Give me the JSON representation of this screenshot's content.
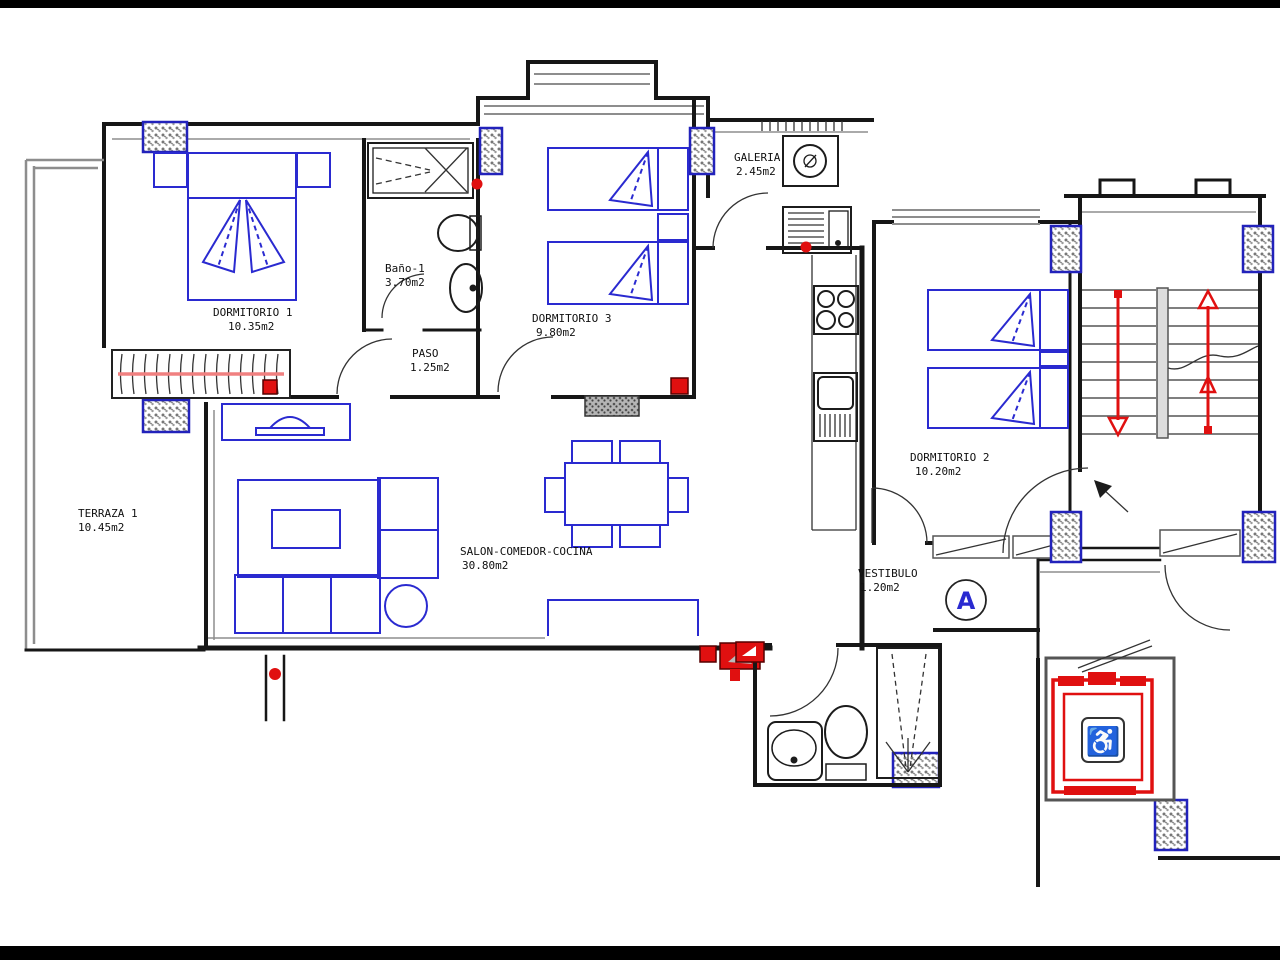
{
  "plan": {
    "rooms": [
      {
        "name": "DORMITORIO 1",
        "area": "10.35m2"
      },
      {
        "name": "Baño-1",
        "area": "3.70m2"
      },
      {
        "name": "DORMITORIO 3",
        "area": "9.80m2"
      },
      {
        "name": "GALERIA",
        "area": "2.45m2"
      },
      {
        "name": "PASO",
        "area": "1.25m2"
      },
      {
        "name": "TERRAZA 1",
        "area": "10.45m2"
      },
      {
        "name": "SALON-COMEDOR-COCINA",
        "area": "30.80m2"
      },
      {
        "name": "DORMITORIO 2",
        "area": "10.20m2"
      },
      {
        "name": "VESTIBULO",
        "area": "1.20m2"
      }
    ],
    "section_label": "A",
    "icons": {
      "wheelchair": "♿"
    },
    "colors": {
      "wall": "#161616",
      "furniture": "#2a2ad0",
      "accent_red": "#e01010",
      "clothesline_pink": "#f08080",
      "column_blue": "#2222bb",
      "detail_gray": "#888888"
    }
  }
}
